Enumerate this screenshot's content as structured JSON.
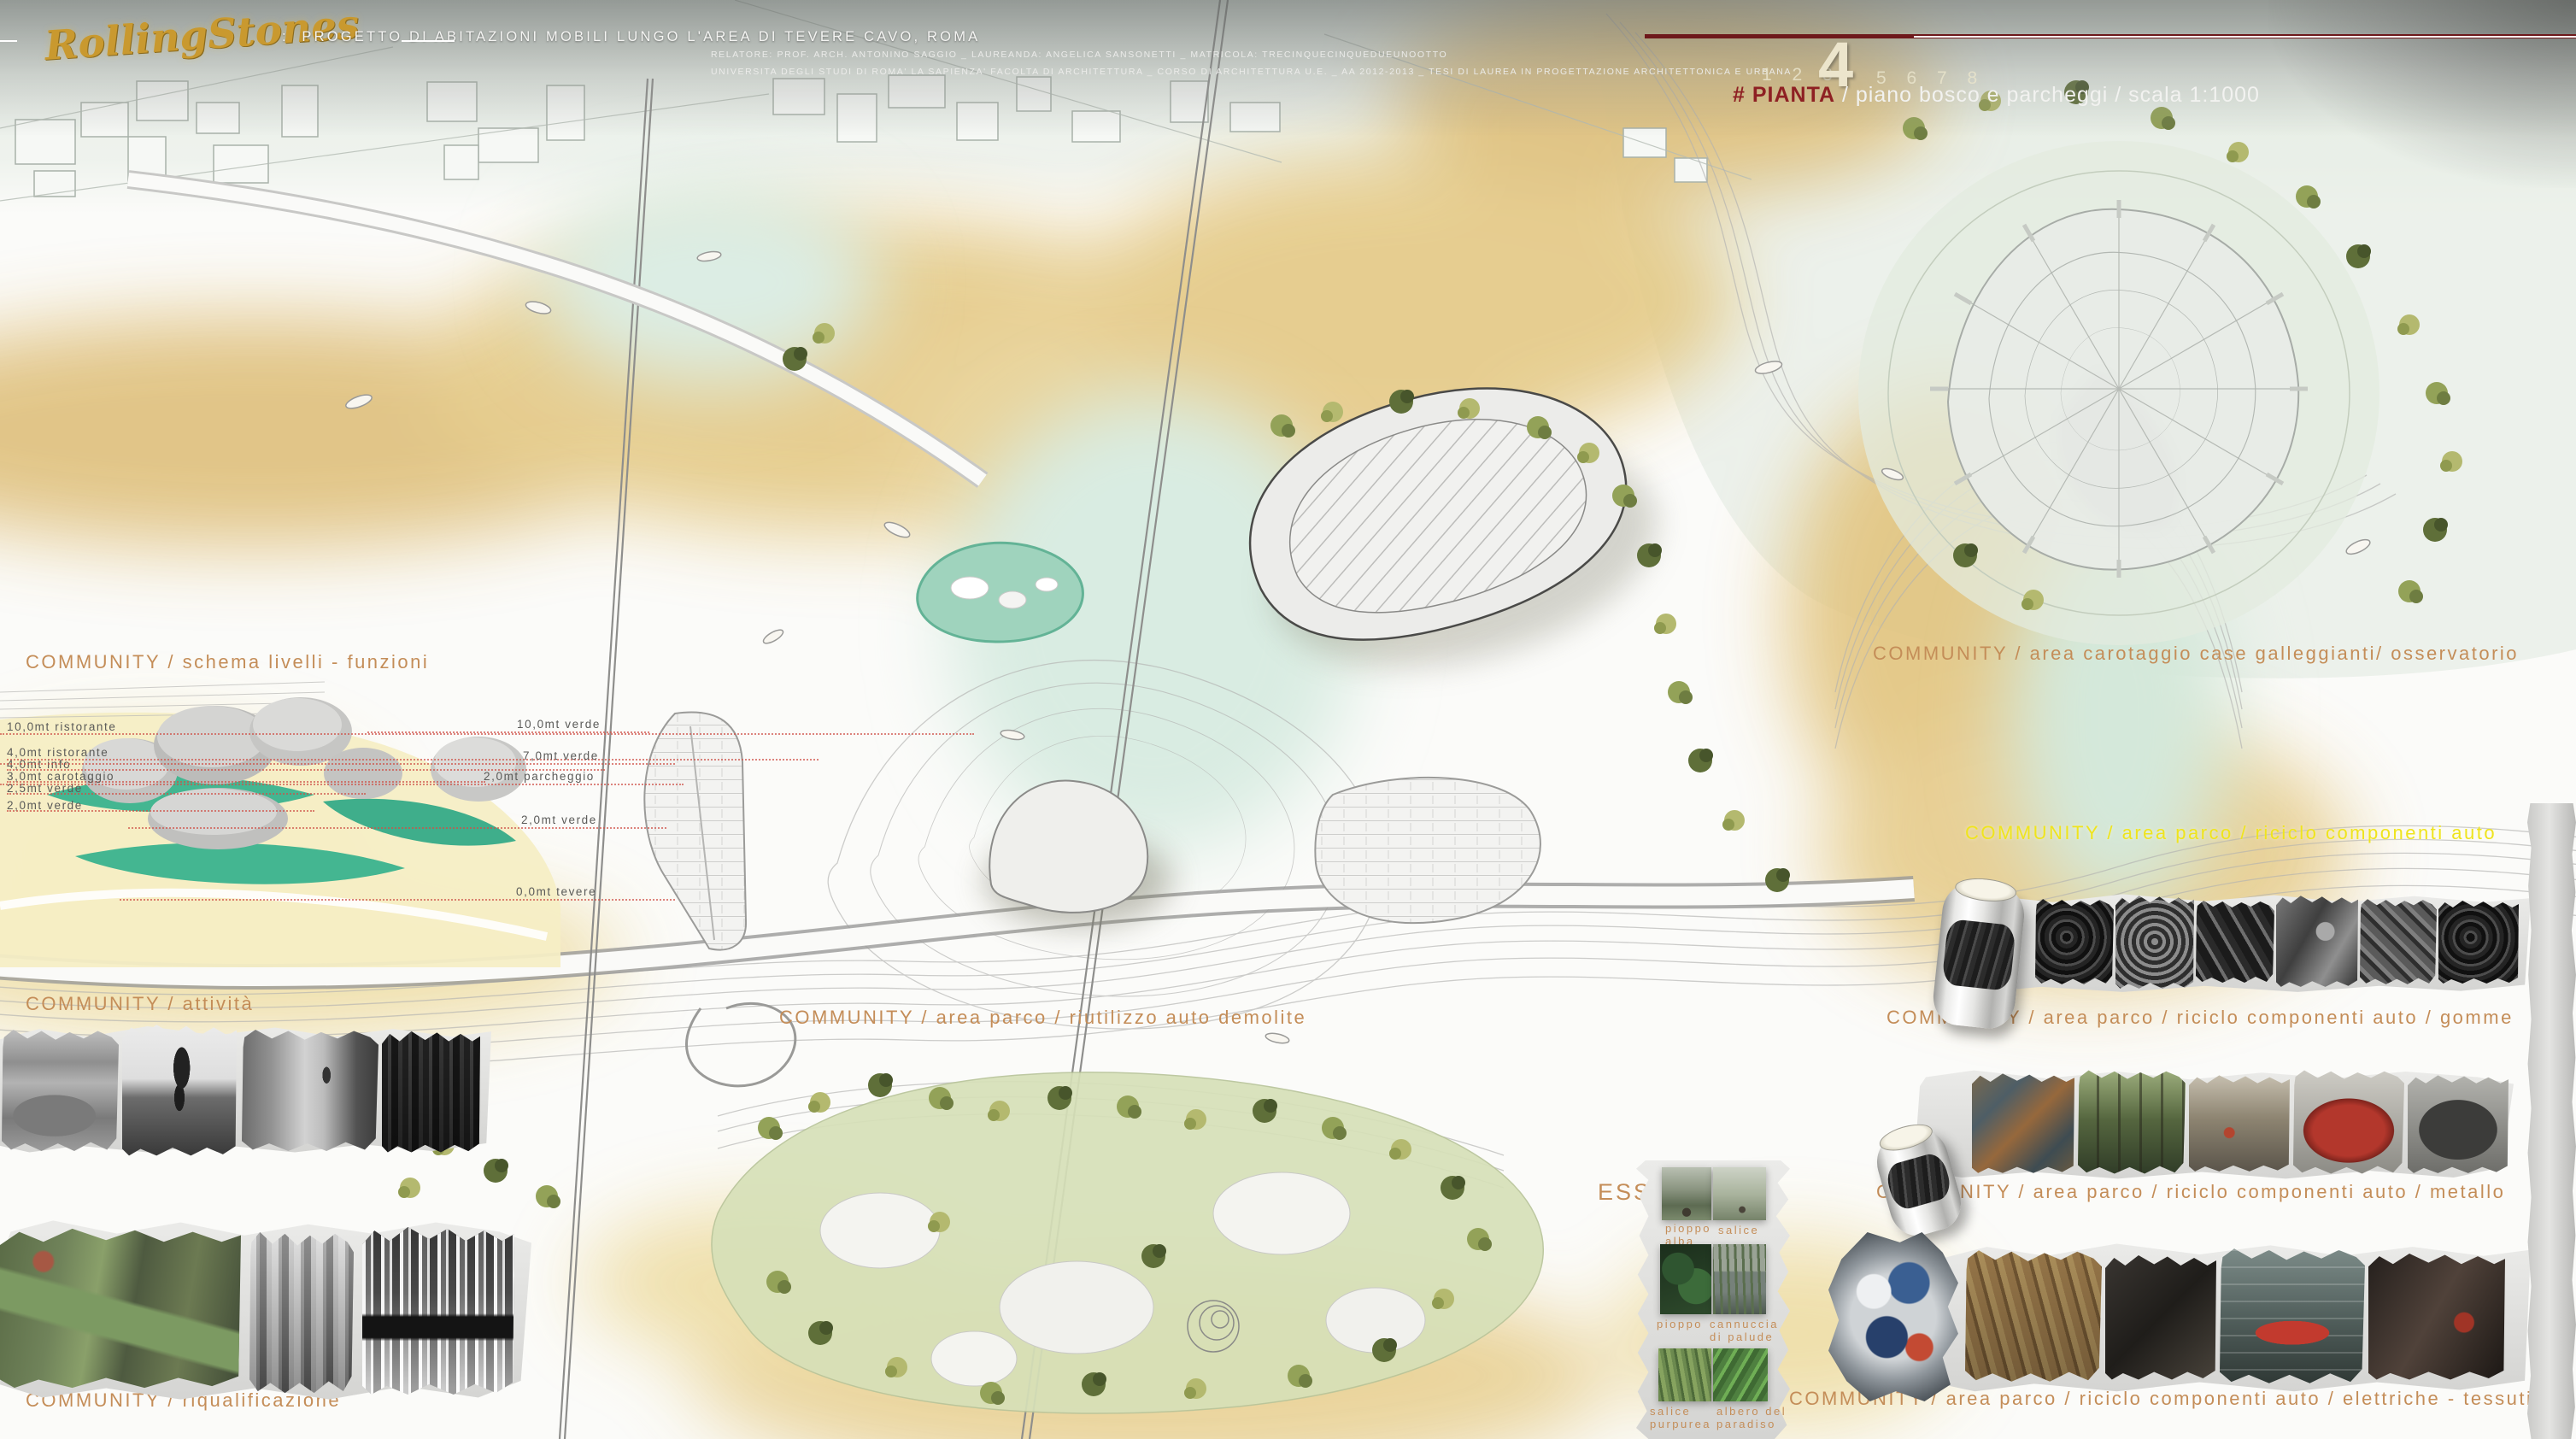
{
  "header": {
    "logo": "RollingStones",
    "separator": ":",
    "title": "PROGETTO DI ABITAZIONI MOBILI LUNGO L'AREA DI TEVERE CAVO, ROMA",
    "credits_line1": "RELATORE: PROF. ARCH. ANTONINO SAGGIO _ LAUREANDA: ANGELICA SANSONETTI _ MATRICOLA: TRECINQUECINQUEDUEUNOOTTO",
    "credits_line2": "UNIVERSITA DEGLI STUDI DI ROMA' LA SAPIENZA' FACOLTA DI ARCHITETTURA _ CORSO DI ARCHITETTURA U.E. _ AA 2012-2013 _ TESI DI LAUREA IN PROGETTAZIONE ARCHITETTONICA E URBANA",
    "sheet_index_left": "1 2 3",
    "current_sheet": "4",
    "sheet_index_right": "5 6 7 8",
    "sheet_label_prefix": "# PIANTA",
    "sheet_label_rest": "/ piano bosco e parcheggi / scala 1:1000"
  },
  "labels": {
    "schema_livelli": "COMMUNITY / schema livelli - funzioni",
    "attivita": "COMMUNITY /  attività",
    "riqualificazione": "COMMUNITY / riqualificazione",
    "riutilizzo": "COMMUNITY / area parco / riutilizzo auto demolite",
    "carotaggio": "COMMUNITY / area carotaggio case galleggianti/ osservatorio",
    "riciclo": "COMMUNITY / area parco / riciclo componenti auto",
    "gomme": "COMMUNITY / area parco / riciclo componenti auto / gomme",
    "metallo": "COMMUNITY / area parco / riciclo componenti auto / metallo",
    "elettriche": "COMMUNITY / area parco / riciclo componenti auto / elettriche - tessuti",
    "essenze": "ESSENZE"
  },
  "section_levels": {
    "left": [
      "10,0mt ristorante",
      "4,0mt ristorante",
      "4,0mt info",
      "3,0mt carotaggio",
      "2,5mt verde",
      "2,0mt verde"
    ],
    "right": [
      "10,0mt verde",
      "7,0mt verde",
      "2,0mt parcheggio",
      "2,0mt verde",
      "0,0mt tevere"
    ]
  },
  "plants": [
    "pioppo alba",
    "salice",
    "pioppo",
    "cannuccia di palude",
    "salice purpurea",
    "albero del paradiso"
  ],
  "photo_strips": {
    "attivita": [
      "skatepark",
      "jogger",
      "cyclists-path",
      "woodland"
    ],
    "riqualificazione": [
      "aerial-river",
      "forest-bw",
      "fountain-jets"
    ],
    "gomme": [
      "rolled-poster",
      "tire-stack",
      "tubes",
      "tire-tread",
      "car-parts",
      "scrapyard",
      "tires-pile"
    ],
    "metallo": [
      "scrap-metal-color",
      "structures-in-trees",
      "workers",
      "red-dome-tent",
      "dark-dome"
    ],
    "elettriche": [
      "crumpled-photo",
      "timber-structure",
      "dark-workshop",
      "car-chassis-textile",
      "dark-interior"
    ]
  },
  "colors": {
    "label_tan": "#c48d58",
    "label_yellow": "#efe41d",
    "accent_red": "#8e2023",
    "sheet_cream": "#ece5cc",
    "river_ochre": "#e3c27f",
    "water_teal": "#44b691",
    "park_green": "#d6e0b8",
    "logo_gold": "#c9992f"
  }
}
